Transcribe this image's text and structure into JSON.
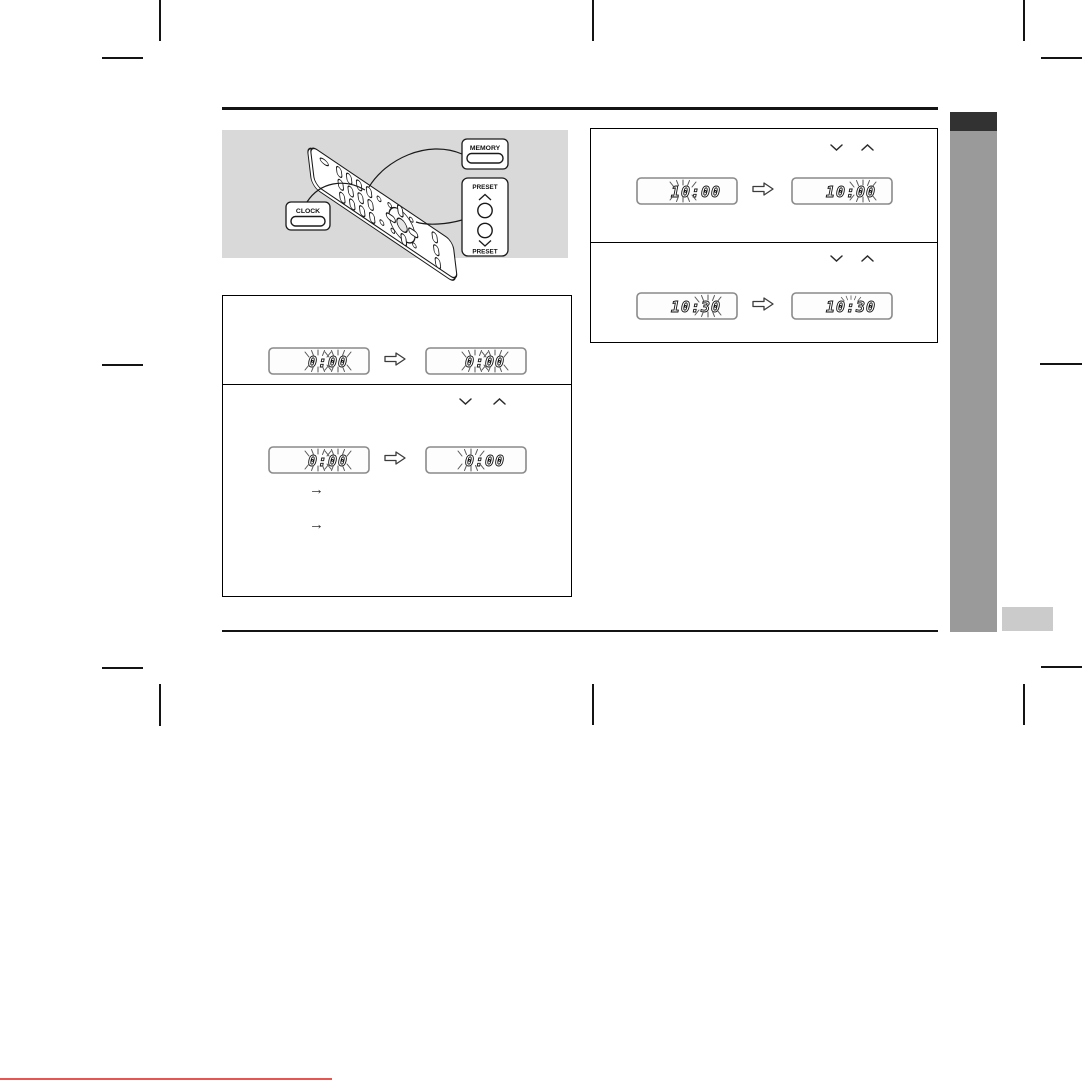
{
  "remote_diagram": {
    "memory_button_label": "MEMORY",
    "clock_button_label": "CLOCK",
    "preset_up_label": "PRESET",
    "preset_down_label": "PRESET"
  },
  "clock_initial_box": {
    "panel_flashing": {
      "display_before": "0:00",
      "display_before_flash": "all digits flashing",
      "display_after": "0:00",
      "display_after_flash": "all digits flashing"
    },
    "panel_hour_select": {
      "display_before": "0:00",
      "display_before_flash": "all digits flashing",
      "display_after": "0:00",
      "display_after_flash": "hour digit flashing",
      "note_arrow_1": "→",
      "note_arrow_2": "→"
    }
  },
  "time_set_box": {
    "panel_set_hour": {
      "display_before": "10:00",
      "display_before_flash": "hour digits flashing",
      "display_after": "10:00",
      "display_after_flash": "minute digits flashing"
    },
    "panel_set_minute": {
      "display_before": "10:30",
      "display_before_flash": "minute digits flashing",
      "display_after": "10:30",
      "display_after_flash": "colon flashing"
    }
  },
  "colors": {
    "accent_red": "#e85450",
    "sidebar_gray": "#9a9a9a",
    "sidebar_dark": "#323232",
    "tab_light_gray": "#cbcbcb",
    "illustration_background": "#d9d9d9"
  }
}
